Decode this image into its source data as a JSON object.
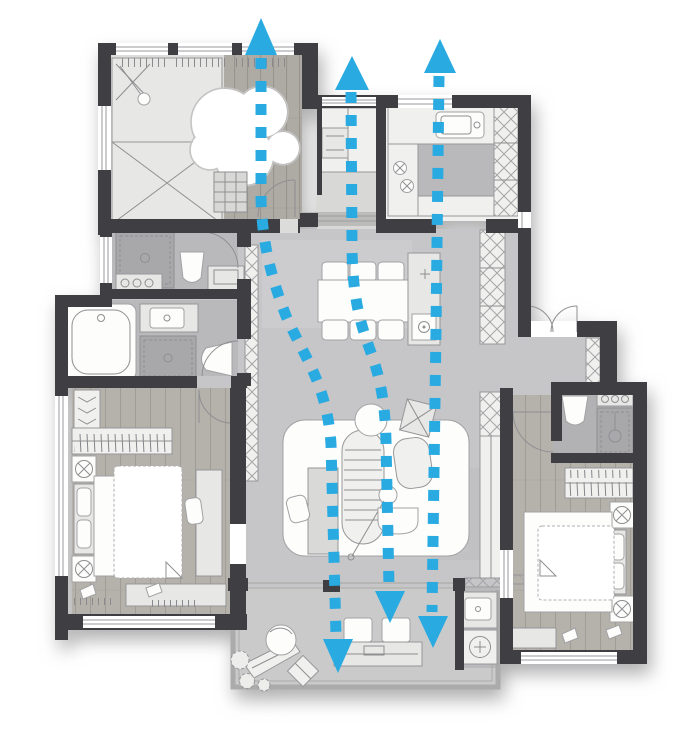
{
  "meta": {
    "description": "apartment floor plan with three vertical airflow / ventilation paths drawn as cyan dashed arrows"
  },
  "colors": {
    "arrow": "#29ABE2",
    "wall": "#3f3f43",
    "floor_marble": "#c6c6c8",
    "floor_wood": "#b2aea8",
    "background": "#ffffff"
  },
  "airflow": {
    "color": "#29ABE2",
    "stroke_width": 11,
    "dash_length": 11,
    "gap_length": 12,
    "flows": [
      {
        "name": "flow-left",
        "trail": "M261,58 L261,198 C262,242 271,277 286,316 C304,357 327,384 331,444 L336,636",
        "start_arrowhead": "261,18 277,55 245,55",
        "end_arrowhead": "338,673 353,639 323,639"
      },
      {
        "name": "flow-middle",
        "trail": "M351,92 L352,250 C353,299 360,322 370,350 C380,377 385,401 386,441 L389,588",
        "start_arrowhead": "352,56 369,90 335,90",
        "end_arrowhead": "390,623 405,591 375,591"
      },
      {
        "name": "flow-right",
        "trail": "M439,76 L436,330 L432,612",
        "start_arrowhead": "440,39 456,73 424,73",
        "end_arrowhead": "433,648 448,616 418,616"
      }
    ]
  }
}
